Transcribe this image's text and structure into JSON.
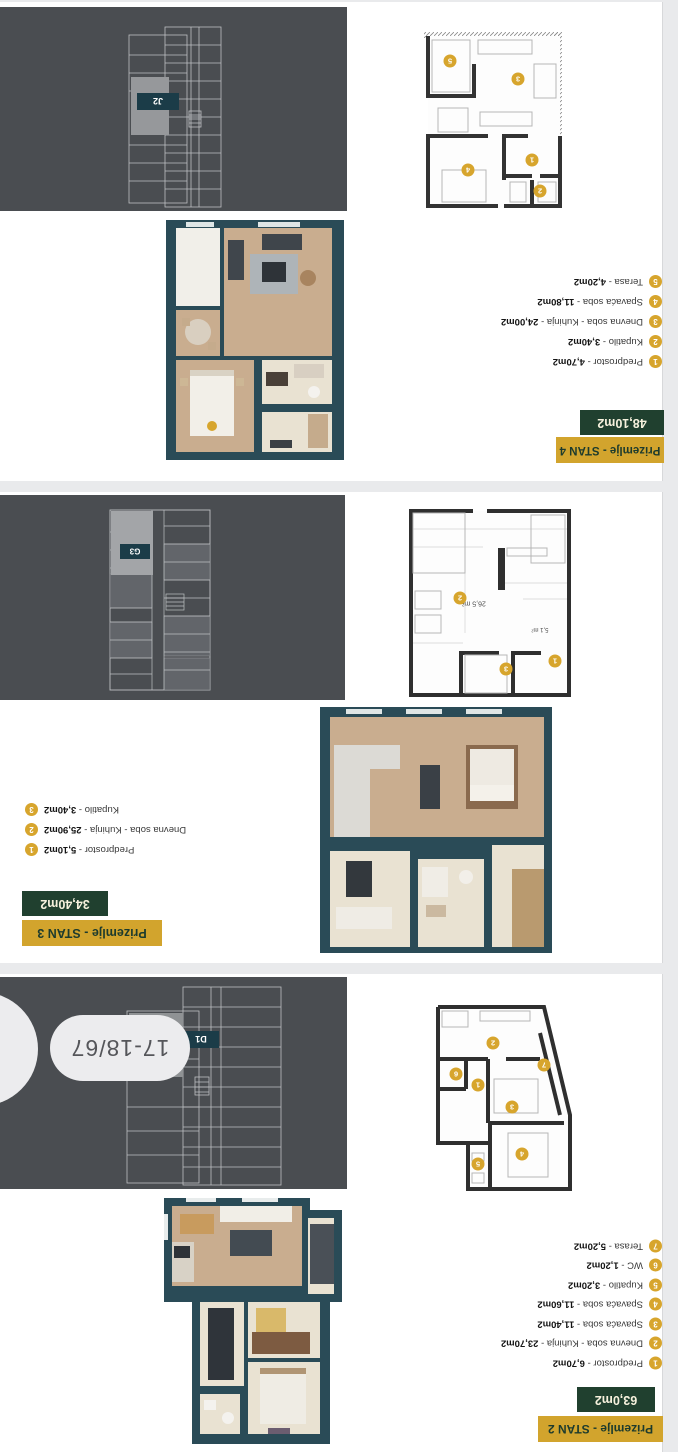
{
  "viewer": {
    "page_indicator": "17-18/67"
  },
  "colors": {
    "gold": "#d2a42d",
    "dark_green": "#20402f",
    "teal_wall": "#2a4b57",
    "panel_gray": "#4a4d51",
    "page_bg": "#ffffff",
    "gutter_gray": "#e9eaec",
    "unit_label_bg": "#1b3c48"
  },
  "sections": [
    {
      "title_badge": "Prizemlje - STAN 4",
      "area_badge": "48,10m2",
      "unit_code": "J2",
      "rooms": [
        {
          "num": "1",
          "name": "Predprostor",
          "area": "4,70m2"
        },
        {
          "num": "2",
          "name": "Kupatilo",
          "area": "3,40m2"
        },
        {
          "num": "3",
          "name": "Dnevna soba - Kuhinja",
          "area": "24,00m2"
        },
        {
          "num": "4",
          "name": "Spavaća soba",
          "area": "11,80m2"
        },
        {
          "num": "5",
          "name": "Terasa",
          "area": "4,20m2"
        }
      ]
    },
    {
      "title_badge": "Prizemlje - STAN 3",
      "area_badge": "34,40m2",
      "unit_code": "G3",
      "plan_labels": {
        "living": "26,5 m²",
        "hall": "5,1 m²"
      },
      "rooms": [
        {
          "num": "1",
          "name": "Predprostor",
          "area": "5,10m2"
        },
        {
          "num": "2",
          "name": "Dnevna soba - Kuhinja",
          "area": "25,90m2"
        },
        {
          "num": "3",
          "name": "Kupatilo",
          "area": "3,40m2"
        }
      ]
    },
    {
      "title_badge": "Prizemlje - STAN 2",
      "area_badge": "63,0m2",
      "unit_code": "D1",
      "rooms": [
        {
          "num": "1",
          "name": "Predprostor",
          "area": "6,70m2"
        },
        {
          "num": "2",
          "name": "Dnevna soba - Kuhinja",
          "area": "23,70m2"
        },
        {
          "num": "3",
          "name": "Spavaća soba",
          "area": "11,40m2"
        },
        {
          "num": "4",
          "name": "Spavaća soba",
          "area": "11,60m2"
        },
        {
          "num": "5",
          "name": "Kupatilo",
          "area": "3,20m2"
        },
        {
          "num": "6",
          "name": "WC",
          "area": "1,20m2"
        },
        {
          "num": "7",
          "name": "Terasa",
          "area": "5,20m2"
        }
      ]
    }
  ]
}
